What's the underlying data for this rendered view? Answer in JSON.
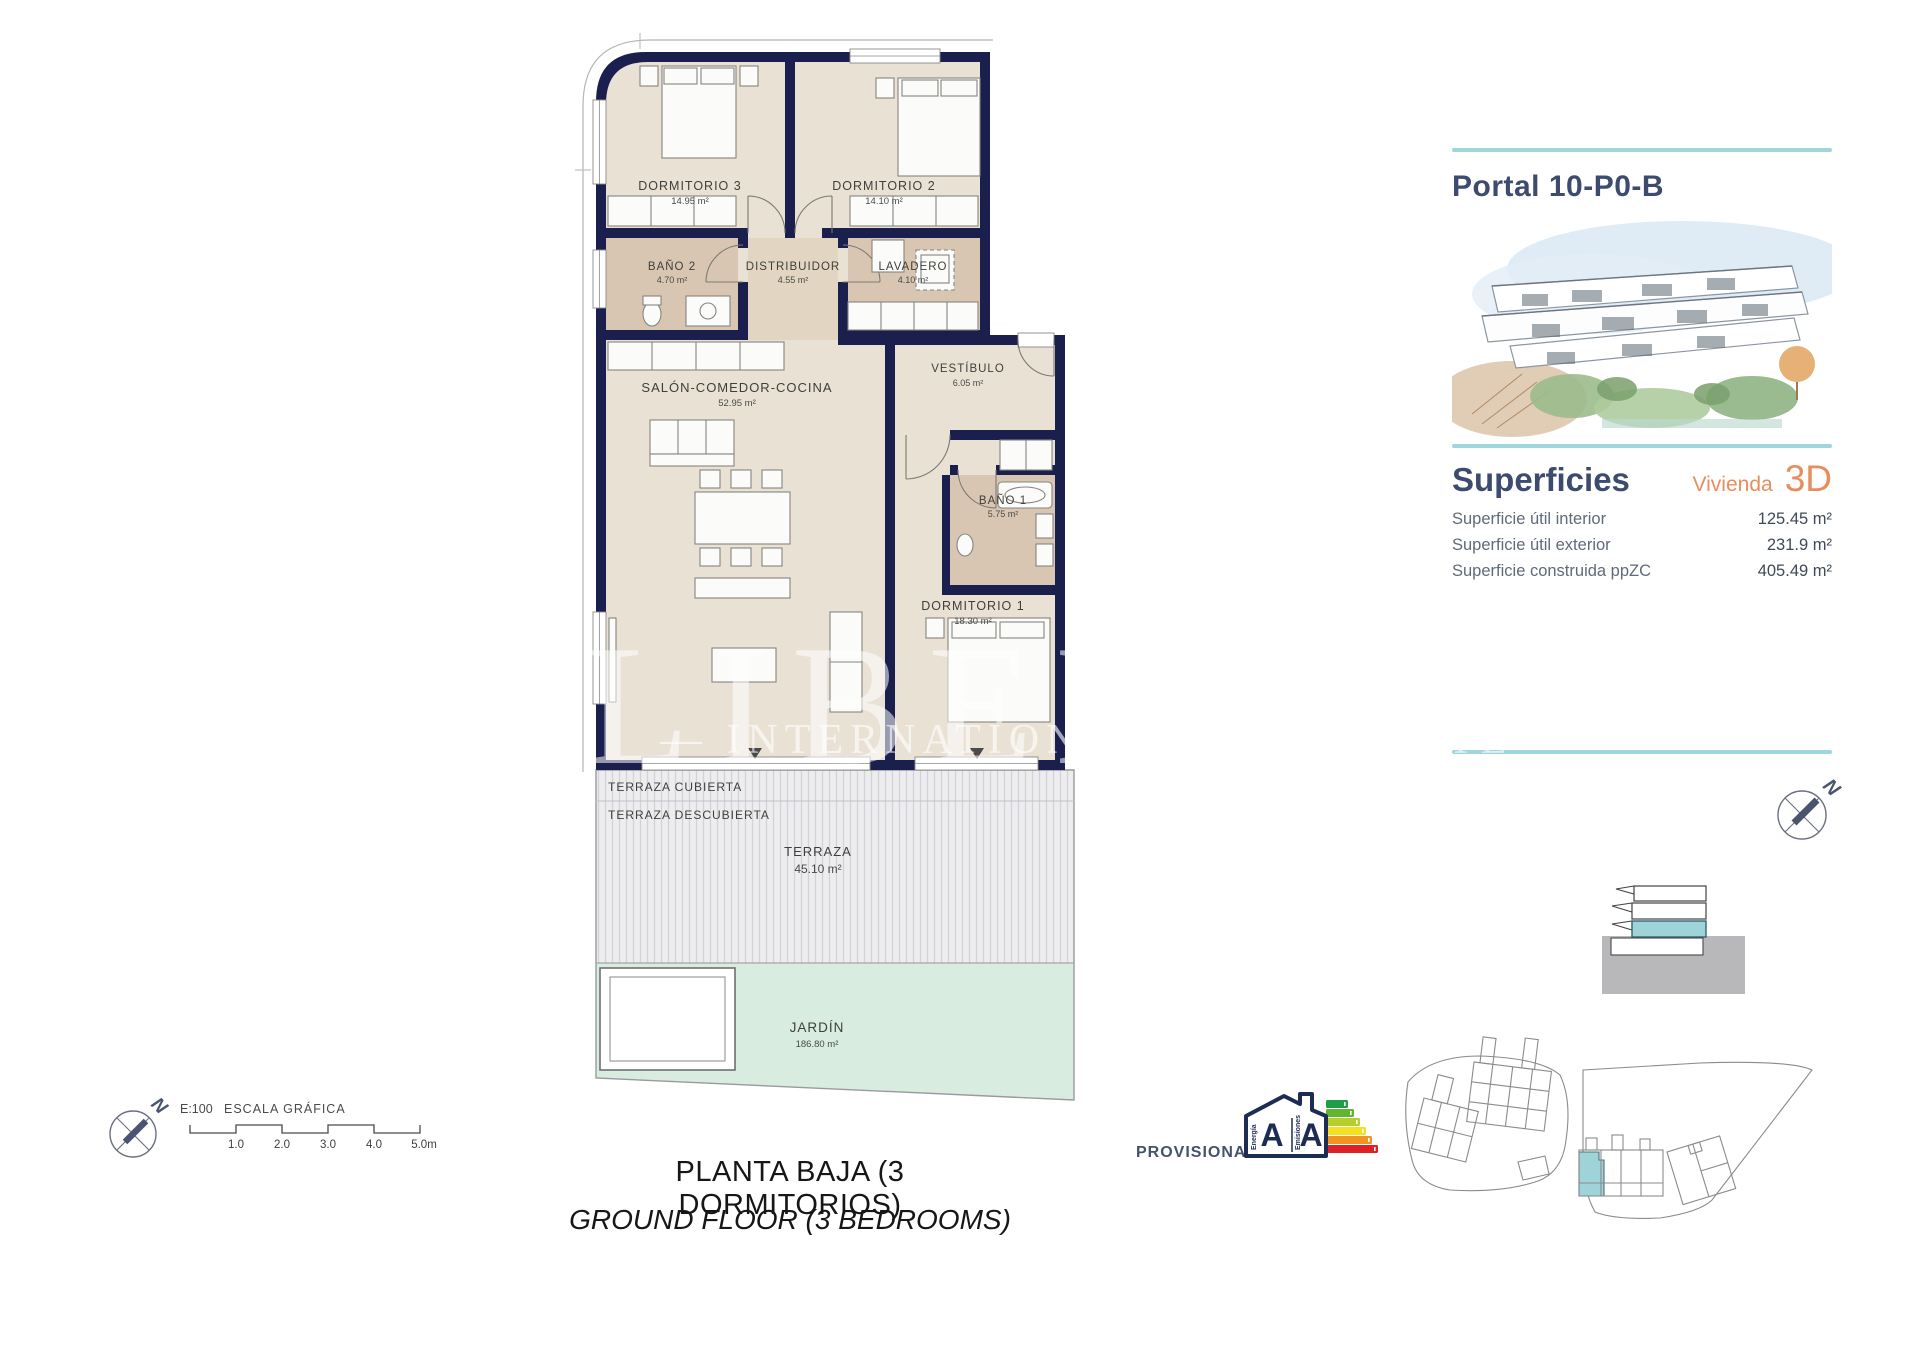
{
  "floor_plan": {
    "rooms": [
      {
        "name": "DORMITORIO 3",
        "area": "14.95 m²"
      },
      {
        "name": "DORMITORIO 2",
        "area": "14.10 m²"
      },
      {
        "name": "BAÑO 2",
        "area": "4.70 m²"
      },
      {
        "name": "DISTRIBUIDOR",
        "area": "4.55 m²"
      },
      {
        "name": "LAVADERO",
        "area": "4.10 m²"
      },
      {
        "name": "VESTÍBULO",
        "area": "6.05 m²"
      },
      {
        "name": "SALÓN-COMEDOR-COCINA",
        "area": "52.95 m²"
      },
      {
        "name": "BAÑO 1",
        "area": "5.75 m²"
      },
      {
        "name": "DORMITORIO 1",
        "area": "18.30 m²"
      }
    ],
    "outdoor": {
      "covered_label": "TERRAZA CUBIERTA",
      "uncovered_label": "TERRAZA DESCUBIERTA",
      "terrace": {
        "name": "TERRAZA",
        "area": "45.10 m²"
      },
      "garden": {
        "name": "JARDÍN",
        "area": "186.80 m²"
      }
    }
  },
  "watermark": {
    "brand": "LIBEHO",
    "tagline": "— INTERNATIONAL REAL ESTATE —"
  },
  "panel": {
    "title": "Portal 10-P0-B",
    "section_title": "Superficies",
    "unit_label": "Vivienda",
    "unit_code": "3D",
    "rows": [
      {
        "label": "Superficie útil interior",
        "value": "125.45 m²"
      },
      {
        "label": "Superficie útil exterior",
        "value": "231.9 m²"
      },
      {
        "label": "Superficie construida ppZC",
        "value": "405.49 m²"
      }
    ]
  },
  "footer": {
    "title_es": "PLANTA BAJA (3 DORMITORIOS)",
    "title_en": "GROUND FLOOR (3 BEDROOMS)"
  },
  "scale_bar": {
    "ratio": "E:100",
    "label": "ESCALA GRÁFICA",
    "ticks": [
      "1.0",
      "2.0",
      "3.0",
      "4.0",
      "5.0m"
    ]
  },
  "energy": {
    "status": "PROVISIONAL",
    "letter_left": "A",
    "letter_right": "A",
    "col_left": "Energía",
    "col_right": "Emisiones"
  },
  "compass": {
    "letter": "N"
  },
  "colors": {
    "wall": "#1b1f4e",
    "floor": "#e9e1d4",
    "wet_room": "#d9c6b2",
    "teal_accent": "#9fd6dc",
    "unit_highlight": "#9fd3da",
    "orange": "#e78e5c",
    "navy_text": "#3c4b6e",
    "garden": "#d8ecdf"
  }
}
